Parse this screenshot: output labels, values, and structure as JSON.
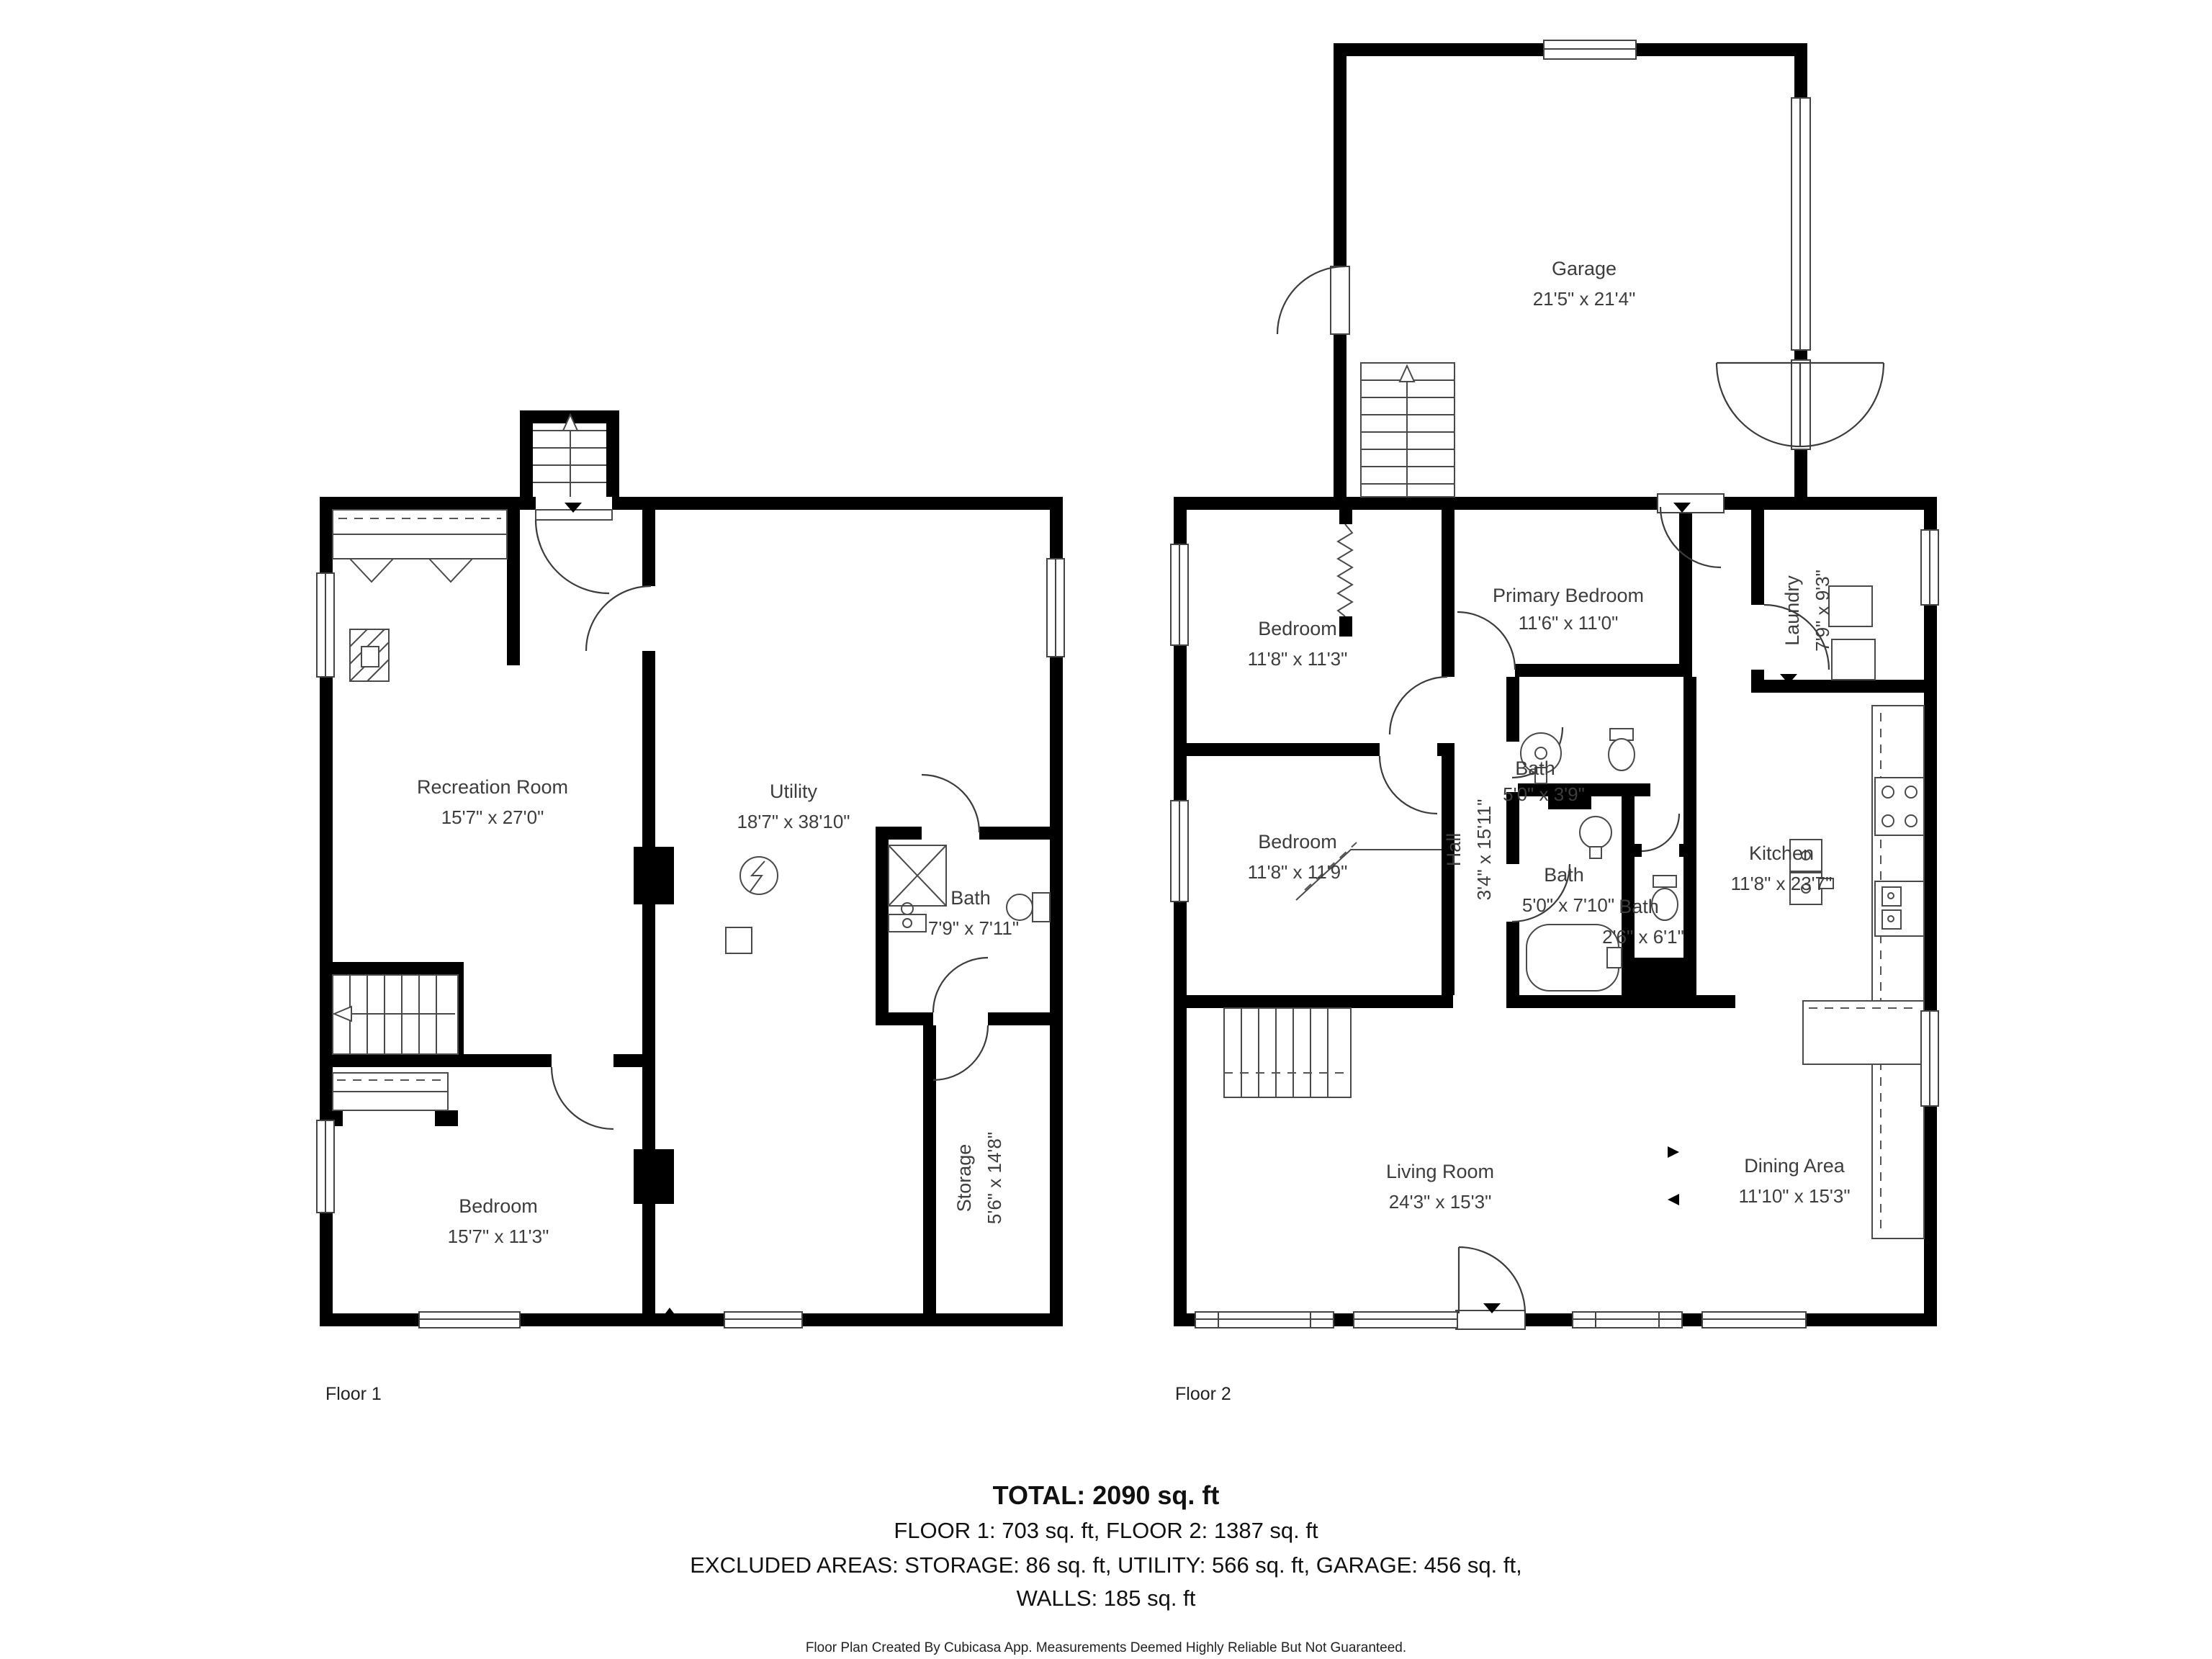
{
  "floor1": {
    "label": "Floor 1",
    "rooms": [
      {
        "name": "Recreation Room",
        "dims": "15'7\" x 27'0\""
      },
      {
        "name": "Utility",
        "dims": "18'7\" x 38'10\""
      },
      {
        "name": "Bath",
        "dims": "7'9\" x 7'11\""
      },
      {
        "name": "Storage",
        "dims": "5'6\" x 14'8\""
      },
      {
        "name": "Bedroom",
        "dims": "15'7\" x 11'3\""
      }
    ]
  },
  "floor2": {
    "label": "Floor 2",
    "rooms": [
      {
        "name": "Garage",
        "dims": "21'5\" x 21'4\""
      },
      {
        "name": "Bedroom",
        "dims": "11'8\" x 11'3\""
      },
      {
        "name": "Primary Bedroom",
        "dims": "11'6\" x 11'0\""
      },
      {
        "name": "Laundry",
        "dims": "7'9\" x 9'3\""
      },
      {
        "name": "Bedroom",
        "dims": "11'8\" x 11'9\""
      },
      {
        "name": "Hall",
        "dims": "3'4\" x 15'11\""
      },
      {
        "name": "Bath",
        "dims": "5'0\" x 3'9\""
      },
      {
        "name": "Bath",
        "dims": "5'0\" x 7'10\""
      },
      {
        "name": "Bath",
        "dims": "2'6\" x 6'1\""
      },
      {
        "name": "Kitchen",
        "dims": "11'8\" x 23'7\""
      },
      {
        "name": "Living Room",
        "dims": "24'3\" x 15'3\""
      },
      {
        "name": "Dining Area",
        "dims": "11'10\" x 15'3\""
      }
    ]
  },
  "summary": {
    "total": "TOTAL: 2090 sq. ft",
    "floors": "FLOOR 1: 703 sq. ft, FLOOR 2: 1387 sq. ft",
    "excluded": "EXCLUDED AREAS: STORAGE: 86 sq. ft, UTILITY: 566 sq. ft, GARAGE: 456 sq. ft,",
    "walls": "WALLS: 185 sq. ft"
  },
  "footer": "Floor Plan Created By Cubicasa App. Measurements Deemed Highly Reliable But Not Guaranteed."
}
